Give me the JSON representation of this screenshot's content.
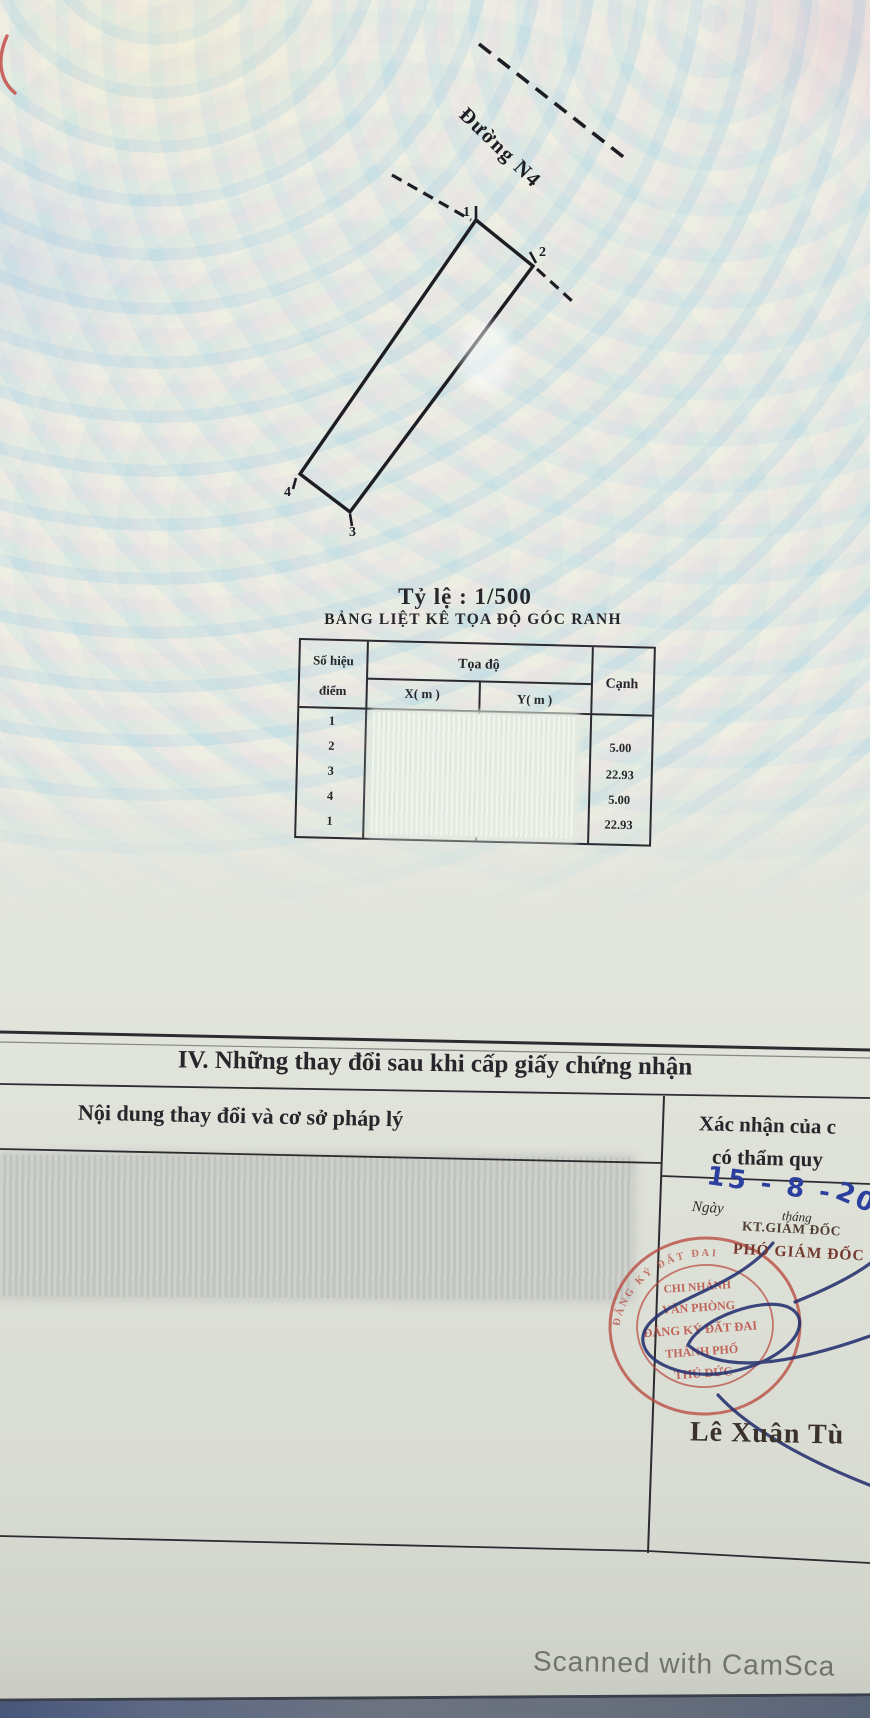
{
  "document": {
    "map": {
      "road_label": "Đường N4",
      "corner_labels": [
        "1",
        "2",
        "3",
        "4"
      ],
      "scale_label": "Tỷ lệ : 1/500"
    },
    "coord_table": {
      "title": "BẢNG LIỆT KÊ TỌA ĐỘ GÓC RANH",
      "col_point_line1": "Số hiệu",
      "col_point_line2": "điểm",
      "col_coords": "Tọa độ",
      "col_x": "X( m )",
      "col_y": "Y( m )",
      "col_edge": "Cạnh",
      "point_numbers": [
        "1",
        "2",
        "3",
        "4",
        "1"
      ],
      "edge_values": [
        "5.00",
        "22.93",
        "5.00",
        "22.93"
      ]
    },
    "section_iv": {
      "heading": "IV. Những thay đổi sau khi cấp giấy chứng nhận",
      "left_column_header": "Nội dung thay đổi và cơ sở pháp lý",
      "right_column_header_line1": "Xác nhận của c",
      "right_column_header_line2": "có thẩm quy",
      "handwritten_date": "15 - 8 -",
      "handwritten_year": "2022",
      "day_label": "Ngày",
      "month_label": "tháng",
      "title_kt": "KT.GIÁM ĐỐC",
      "title_pho": "PHÓ GIÁM ĐỐC",
      "signer_name": "Lê Xuân Tù",
      "stamp_lines": [
        "CHI NHÁNH",
        "VĂN PHÒNG",
        "ĐĂNG KÝ ĐẤT ĐAI",
        "THÀNH PHỐ",
        "THỦ ĐỨC"
      ],
      "stamp_rim_text": "ĐĂNG KÝ ĐẤT ĐAI"
    },
    "footer": {
      "scan_watermark": "Scanned with CamSca"
    },
    "colors": {
      "stamp_red": "#b8453a",
      "ink_blue": "#2b3f9e",
      "paper_top": "#e9eee7",
      "paper_bottom": "#d8dbd2"
    }
  }
}
